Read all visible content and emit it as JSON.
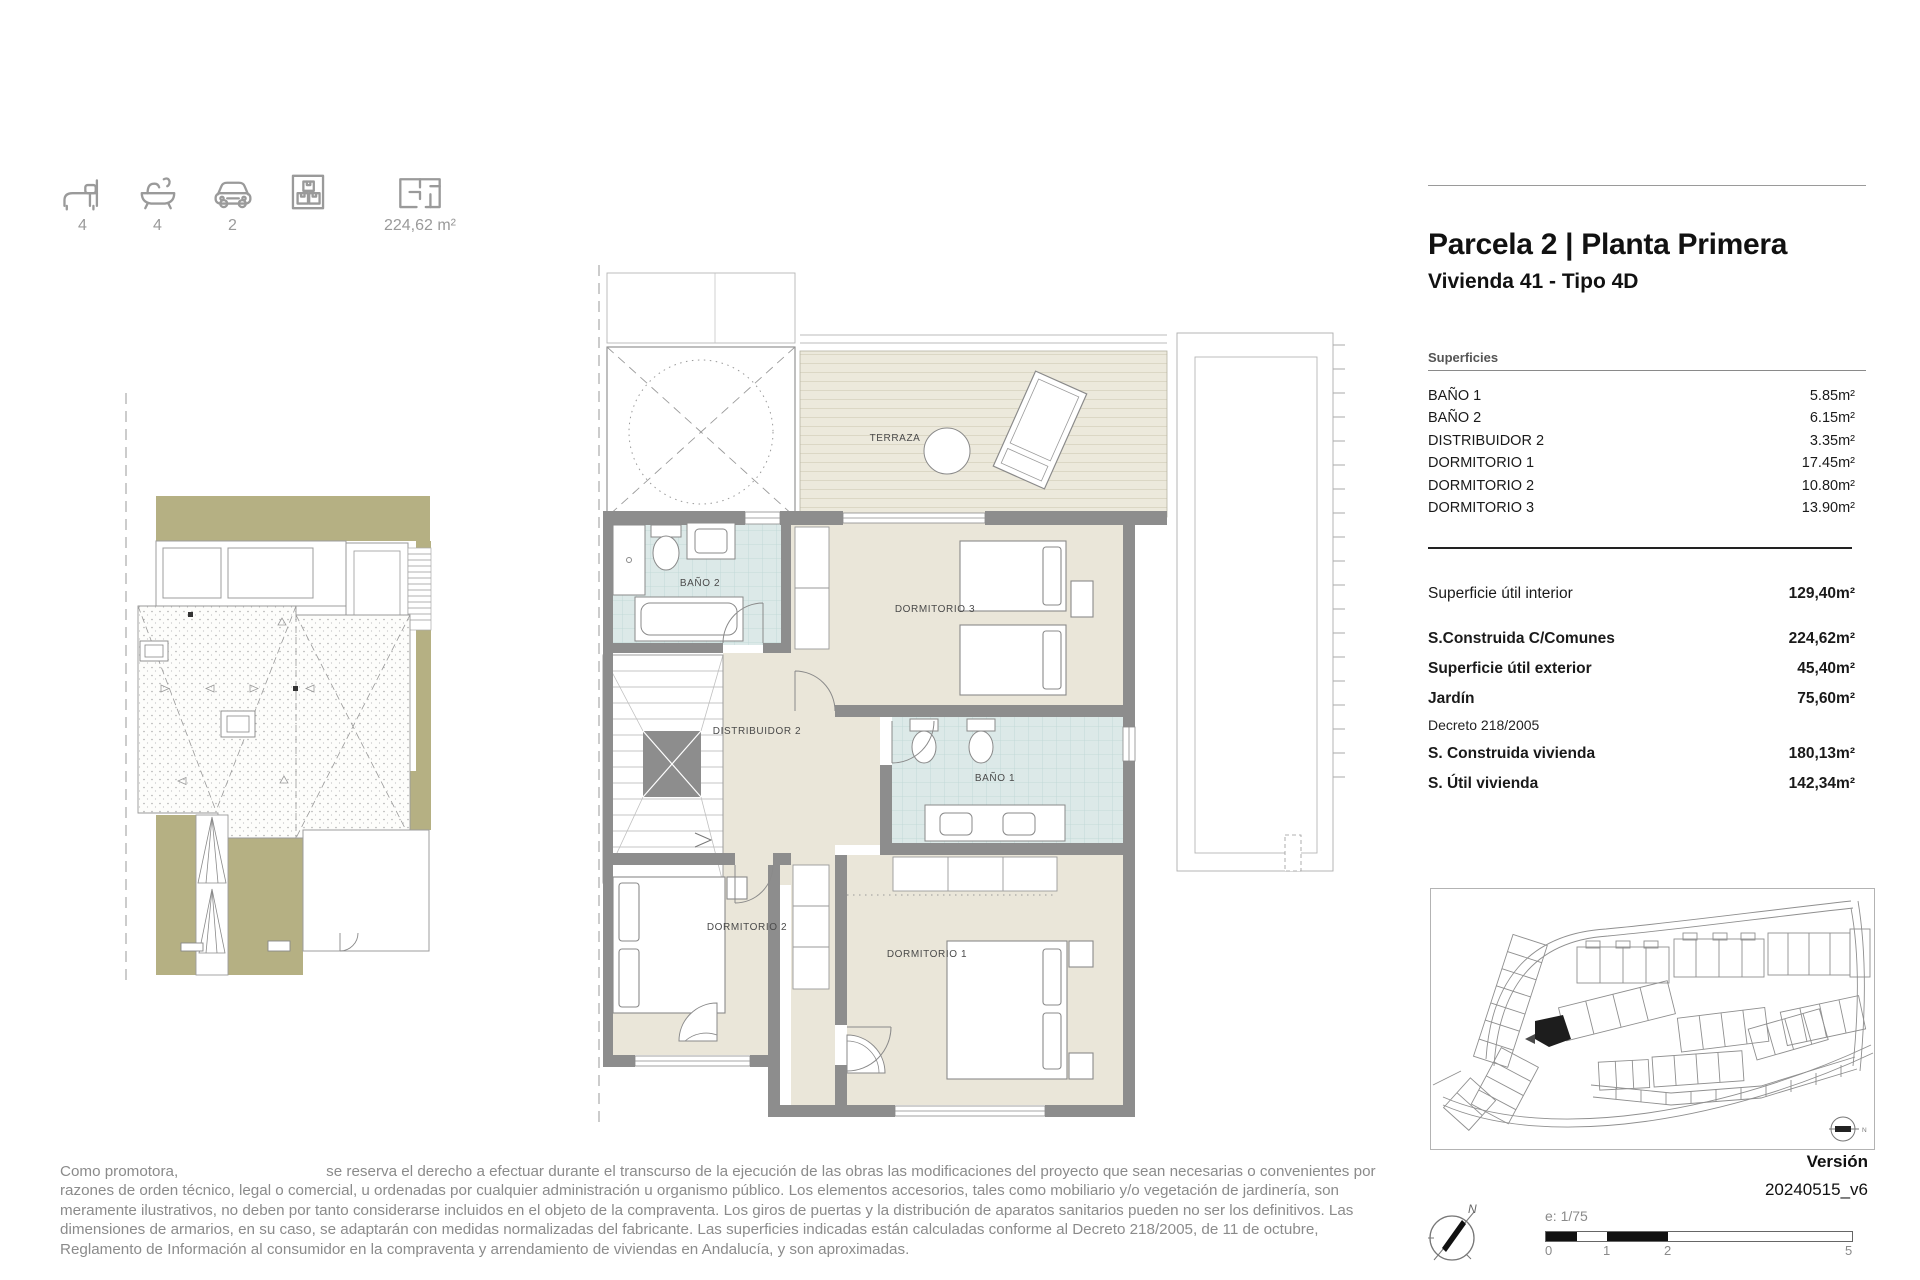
{
  "header_icons": {
    "beds": "4",
    "baths": "4",
    "cars": "2",
    "area": "224,62 m²"
  },
  "title_block": {
    "title": "Parcela 2 | Planta Primera",
    "subtitle": "Vivienda 41 - Tipo 4D"
  },
  "superficies": {
    "heading": "Superficies",
    "rows": [
      {
        "label": "BAÑO 1",
        "value": "5.85m²"
      },
      {
        "label": "BAÑO 2",
        "value": "6.15m²"
      },
      {
        "label": "DISTRIBUIDOR 2",
        "value": "3.35m²"
      },
      {
        "label": "DORMITORIO 1",
        "value": "17.45m²"
      },
      {
        "label": "DORMITORIO 2",
        "value": "10.80m²"
      },
      {
        "label": "DORMITORIO 3",
        "value": "13.90m²"
      }
    ]
  },
  "summary": {
    "util_interior_label": "Superficie útil interior",
    "util_interior_value": "129,40m²",
    "construida_comunes_label": "S.Construida C/Comunes",
    "construida_comunes_value": "224,62m²",
    "util_exterior_label": "Superficie útil exterior",
    "util_exterior_value": "45,40m²",
    "jardin_label": "Jardín",
    "jardin_value": "75,60m²",
    "decreto": "Decreto 218/2005",
    "construida_vivienda_label": "S. Construida vivienda",
    "construida_vivienda_value": "180,13m²",
    "util_vivienda_label": "S. Útil vivienda",
    "util_vivienda_value": "142,34m²"
  },
  "plan_labels": {
    "terraza": "TERRAZA",
    "bano2": "BAÑO 2",
    "dormitorio3": "DORMITORIO 3",
    "distribuidor2": "DISTRIBUIDOR 2",
    "bano1": "BAÑO 1",
    "dormitorio2": "DORMITORIO 2",
    "dormitorio1": "DORMITORIO 1"
  },
  "version_block": {
    "label": "Versión",
    "value": "20240515_v6"
  },
  "scale_bar": {
    "label": "e:  1/75",
    "ticks": [
      "0",
      "1",
      "2",
      "5"
    ]
  },
  "compass": {
    "north": "N"
  },
  "site_map": {
    "north": "N"
  },
  "disclaimer": {
    "prefix": "Como promotora,",
    "body": "se reserva el derecho a efectuar durante el transcurso de la ejecución de las obras las modificaciones del proyecto que sean necesarias o convenientes por razones de orden técnico, legal o comercial, u ordenadas por cualquier administración u organismo público. Los elementos accesorios, tales como mobiliario y/o vegetación de jardinería, son meramente ilustrativos, no deben por tanto considerarse incluidos en el objeto de la compraventa. Los giros de puertas y la distribución de aparatos sanitarios pueden no ser los definitivos. Las dimensiones de armarios, en su caso, se adaptarán con medidas normalizadas del fabricante. Las superficies indicadas están calculadas conforme al Decreto 218/2005, de 11 de octubre, Reglamento de Información al consumidor en la compraventa y arrendamiento de viviendas en Andalucía, y son aproximadas."
  },
  "colors": {
    "floor_beige": "#EAE6D9",
    "tile_blue": "#DCE9E8",
    "terrace_deck": "#ECE9DC",
    "wall_gray": "#8D8D8D",
    "olive_green": "#B5B083",
    "text_gray": "#8B8B8B"
  }
}
